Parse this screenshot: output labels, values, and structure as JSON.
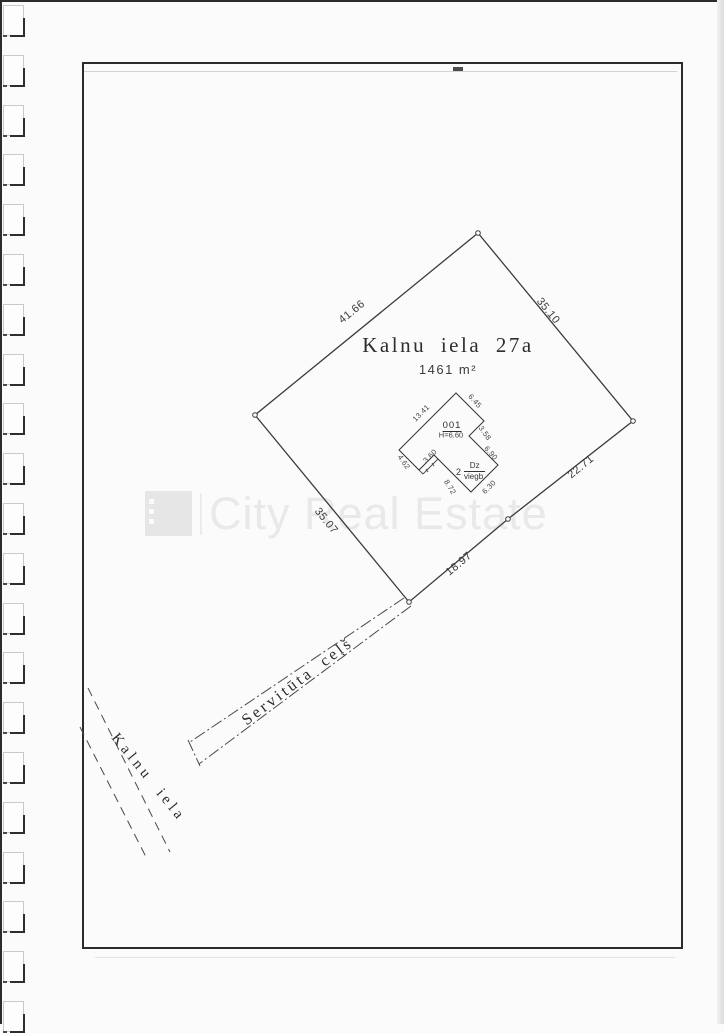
{
  "plot": {
    "title": "Kalnu iela 27a",
    "area": "1461 m²",
    "boundary_lengths": {
      "nw": "41.66",
      "ne": "35.10",
      "e": "22.71",
      "se": "18.97",
      "sw": "35.07"
    }
  },
  "building": {
    "id": "001",
    "height": "H=6.60",
    "storeys": "2",
    "type_code": "Dz",
    "construction": "viegb.",
    "edges": {
      "nw": "13.41",
      "ne": "6.45",
      "step": "3.58",
      "e": "6.90",
      "se": "6.30",
      "sw": "8.72",
      "porch": "3.60",
      "w": "4.62"
    }
  },
  "labels": {
    "servitude_road": "Servitūta ceļš",
    "street": "Kalnu iela"
  },
  "watermark": {
    "text": "City Real Estate"
  },
  "colors": {
    "line": "#3a3a3a",
    "frame": "#2b2b2b",
    "watermark": "#e9e9e9"
  }
}
